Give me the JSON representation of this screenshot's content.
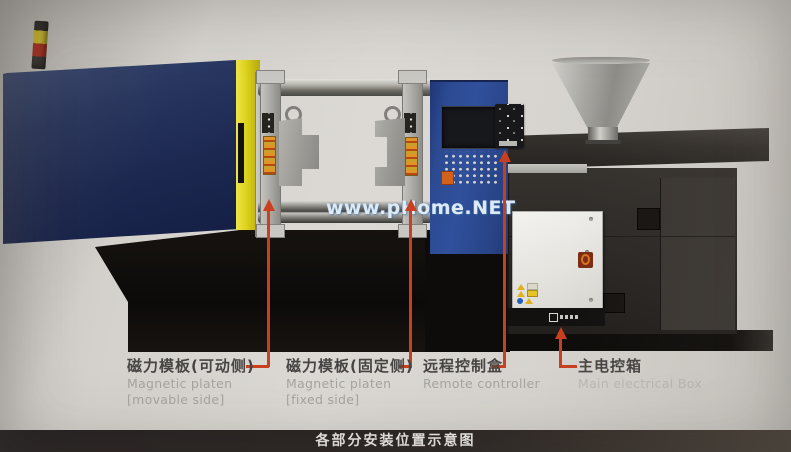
{
  "watermark": {
    "text": "www.pHome.NET"
  },
  "caption": {
    "text": "各部分安装位置示意图"
  },
  "labels": [
    {
      "zh": "磁力模板(可动侧)",
      "en_line1": "Magnetic platen",
      "en_line2": "[movable side]"
    },
    {
      "zh": "磁力模板(固定侧)",
      "en_line1": "Magnetic platen",
      "en_line2": "[fixed side]"
    },
    {
      "zh": "远程控制盒",
      "en_line1": "Remote controller",
      "en_line2": ""
    },
    {
      "zh": "主电控箱",
      "en_line1": "Main electrical Box",
      "en_line2": ""
    }
  ],
  "colors": {
    "accent_red": "#c8401f",
    "machine_navy": "#1c2850",
    "machine_yellow": "#ded41c",
    "cabinet_blue": "#30509c",
    "caption_bar": "#2a2422"
  }
}
